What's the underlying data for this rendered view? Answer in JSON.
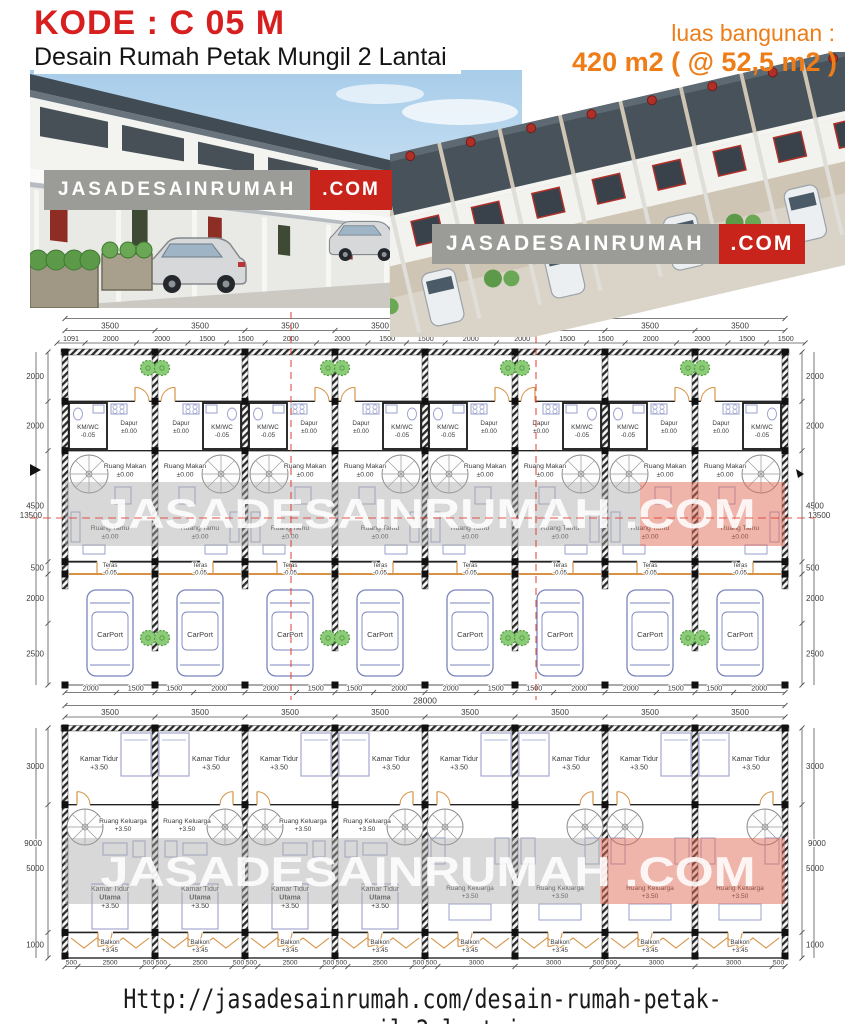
{
  "header": {
    "kode": "KODE : C 05 M",
    "subtitle": "Desain Rumah Petak Mungil 2 Lantai",
    "area_label": "luas bangunan :",
    "area_value": "420 m2 ( @ 52,5 m2 )"
  },
  "watermark": {
    "name": "JASADESAINRUMAH",
    "tld": ".COM"
  },
  "footer": {
    "url": "Http://jasadesainrumah.com/desain-rumah-petak-mungil-2-lantai"
  },
  "colors": {
    "kode_red": "#d71f1f",
    "accent_orange": "#ee7d18",
    "watermark_gray": "#9b9b97",
    "watermark_red": "#c9241c",
    "plan_furniture": "#9aa0cc",
    "plan_door": "#d79245",
    "plan_tree": "#8ccb77",
    "section_red": "#e23b2e"
  },
  "plan1": {
    "units": 8,
    "overall_width_mm": "28000",
    "unit_width_mm": "3500",
    "overall_height_mm": "13500",
    "top_sub_dims": [
      "1091",
      "2000",
      "2000",
      "1500",
      "1500",
      "2000",
      "2000",
      "1500",
      "1500",
      "2000",
      "2000",
      "1500",
      "1500",
      "2000",
      "2000",
      "1500",
      "1500"
    ],
    "bottom_sub_dims": [
      "2000",
      "1500",
      "1500",
      "2000",
      "2000",
      "1500",
      "1500",
      "2000",
      "2000",
      "1500",
      "1500",
      "2000",
      "2000",
      "1500",
      "1500",
      "2000"
    ],
    "side_dims": [
      "2000",
      "2000",
      "4500",
      "500",
      "2000",
      "2500"
    ],
    "rooms": {
      "kmwc": {
        "name": "KM/WC",
        "level": "-0.05"
      },
      "dapur": {
        "name": "Dapur",
        "level": "±0.00"
      },
      "ruang_makan": {
        "name": "Ruang Makan",
        "level": "±0.00"
      },
      "ruang_tamu": {
        "name": "Ruang Tamu",
        "level": "±0.00"
      },
      "teras": {
        "name": "Teras",
        "level": "-0.05"
      },
      "carport": {
        "name": "CarPort"
      }
    }
  },
  "plan2": {
    "units": 8,
    "overall_width_mm": "28000",
    "unit_width_mm": "3500",
    "overall_height_mm": "9000",
    "bottom_sub_dims": [
      "500",
      "2500",
      "500",
      "500",
      "2500",
      "500",
      "500",
      "2500",
      "500",
      "500",
      "2500",
      "500",
      "500",
      "3000",
      "3000",
      "500",
      "500",
      "3000",
      "3000",
      "500"
    ],
    "side_dims": [
      "3000",
      "5000",
      "1000"
    ],
    "rooms": {
      "kamar_tidur": {
        "name": "Kamar Tidur",
        "level": "+3.50"
      },
      "ruang_keluarga": {
        "name": "Ruang Keluarga",
        "level": "+3.50"
      },
      "kamar_tidur_utama": {
        "name": "Kamar Tidur",
        "name2": "Utama",
        "level": "+3.50"
      },
      "balkon": {
        "name": "Balkon",
        "level": "+3.45"
      }
    }
  }
}
